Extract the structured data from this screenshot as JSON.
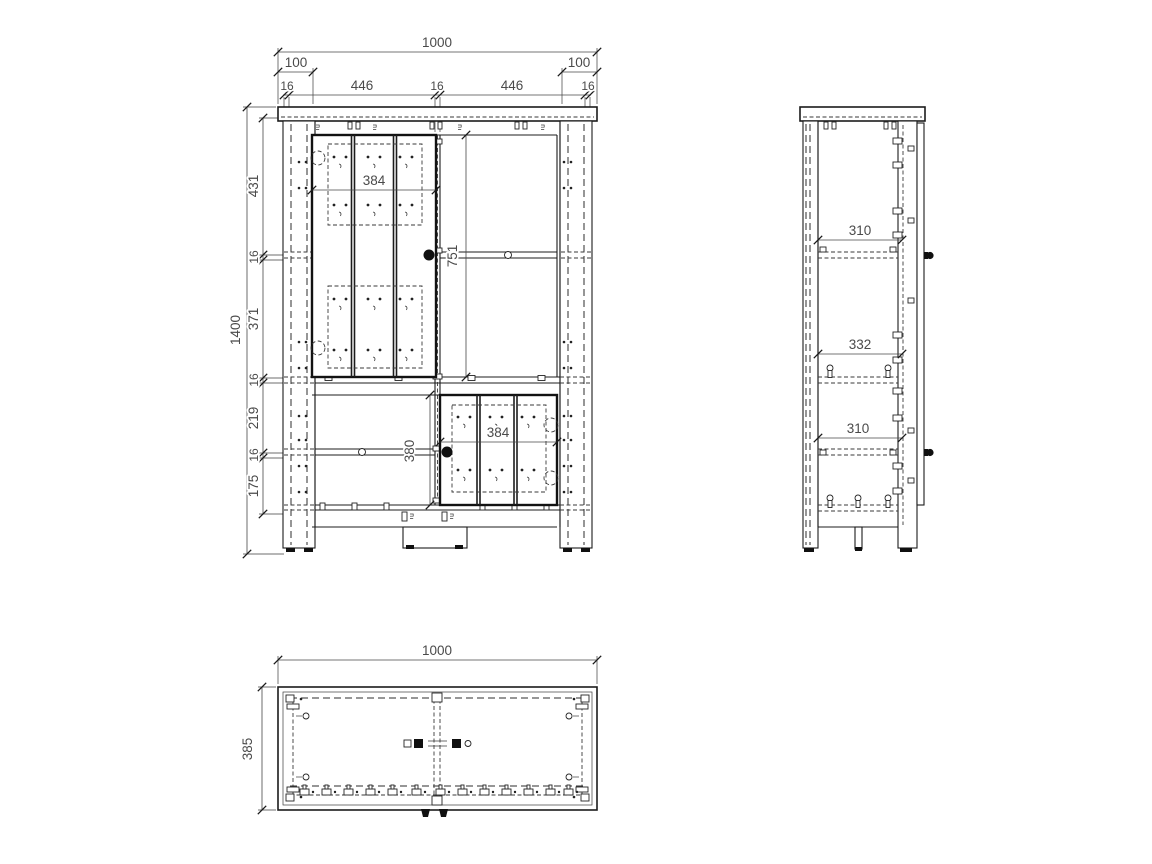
{
  "drawing": {
    "background": "#ffffff",
    "line_color": "#1c1c1c",
    "dim_text_color": "#4a4a4a"
  },
  "views": {
    "front": {
      "label": "front-elevation",
      "dims": {
        "overall_width": "1000",
        "leg_width_left": "100",
        "leg_width_right": "100",
        "top_chain": [
          "16",
          "446",
          "16",
          "446",
          "16"
        ],
        "overall_height": "1400",
        "left_chain": [
          "431",
          "16",
          "371",
          "16",
          "219",
          "16",
          "175"
        ],
        "upper_door_width": "384",
        "upper_door_height": "751",
        "lower_opening_height": "380",
        "lower_door_width": "384"
      }
    },
    "side": {
      "label": "side-elevation",
      "dims": {
        "shelf_depths": [
          "310",
          "332",
          "310"
        ]
      }
    },
    "plan": {
      "label": "top-plan",
      "dims": {
        "overall_width": "1000",
        "overall_depth": "385"
      }
    }
  }
}
